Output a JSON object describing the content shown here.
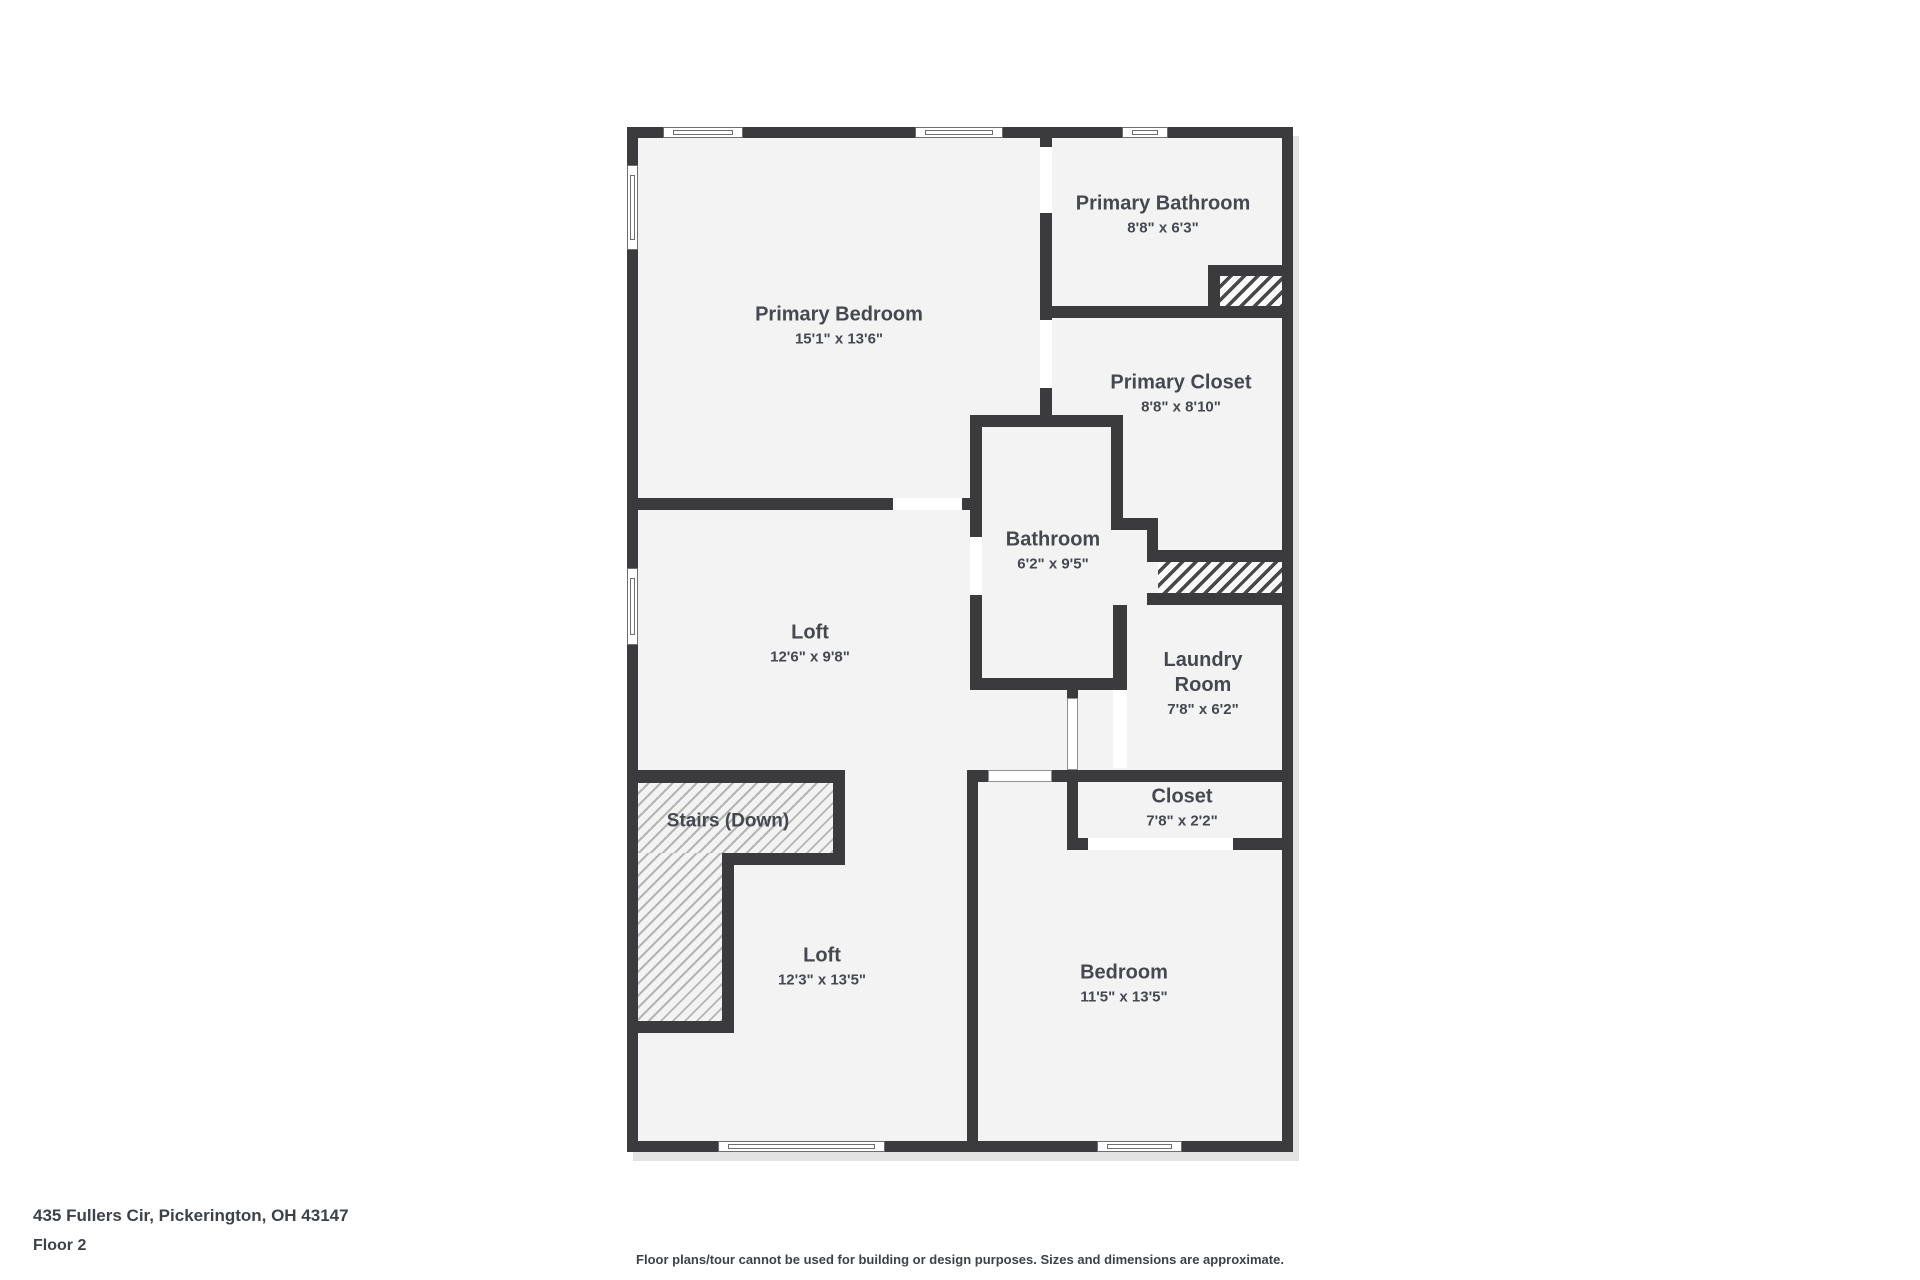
{
  "plan": {
    "bbox": {
      "left": 627,
      "top": 127,
      "width": 666,
      "height": 1025
    },
    "colors": {
      "wall": "#3b3b3d",
      "floor": "#f3f3f3",
      "label_text": "#45484e",
      "footer_text": "#3e4247",
      "shadow": "#e3e3e3"
    },
    "rooms": [
      {
        "id": "primary-bedroom",
        "name": "Primary Bedroom",
        "dims": "15'1\" x 13'6\"",
        "cx": 212,
        "cy": 200
      },
      {
        "id": "primary-bathroom",
        "name": "Primary Bathroom",
        "dims": "8'8\" x 6'3\"",
        "cx": 536,
        "cy": 89
      },
      {
        "id": "primary-closet",
        "name": "Primary Closet",
        "dims": "8'8\" x 8'10\"",
        "cx": 554,
        "cy": 268
      },
      {
        "id": "bathroom",
        "name": "Bathroom",
        "dims": "6'2\" x 9'5\"",
        "cx": 426,
        "cy": 425
      },
      {
        "id": "laundry-room",
        "name": "Laundry Room",
        "dims": "7'8\" x 6'2\"",
        "cx": 576,
        "cy": 558,
        "wrap": true
      },
      {
        "id": "closet",
        "name": "Closet",
        "dims": "7'8\" x 2'2\"",
        "cx": 555,
        "cy": 682
      },
      {
        "id": "bedroom",
        "name": "Bedroom",
        "dims": "11'5\" x 13'5\"",
        "cx": 497,
        "cy": 858
      },
      {
        "id": "loft-upper",
        "name": "Loft",
        "dims": "12'6\" x 9'8\"",
        "cx": 183,
        "cy": 518
      },
      {
        "id": "loft-lower",
        "name": "Loft",
        "dims": "12'3\" x 13'5\"",
        "cx": 195,
        "cy": 841
      },
      {
        "id": "stairs",
        "name": "Stairs (Down)",
        "dims": "",
        "cx": 101,
        "cy": 694
      }
    ],
    "walls": [
      [
        0,
        0,
        666,
        11
      ],
      [
        0,
        1014,
        666,
        11
      ],
      [
        0,
        0,
        11,
        1025
      ],
      [
        655,
        0,
        11,
        1025
      ],
      [
        413,
        11,
        12,
        9
      ],
      [
        413,
        86,
        12,
        107
      ],
      [
        413,
        261,
        12,
        28
      ],
      [
        343,
        288,
        153,
        12
      ],
      [
        413,
        179,
        253,
        12
      ],
      [
        581,
        138,
        12,
        53
      ],
      [
        581,
        138,
        75,
        11
      ],
      [
        484,
        300,
        12,
        103
      ],
      [
        484,
        391,
        47,
        12
      ],
      [
        520,
        403,
        11,
        32
      ],
      [
        520,
        423,
        146,
        12
      ],
      [
        520,
        466,
        146,
        12
      ],
      [
        486,
        478,
        14,
        85
      ],
      [
        343,
        288,
        12,
        122
      ],
      [
        343,
        468,
        12,
        95
      ],
      [
        343,
        551,
        157,
        12
      ],
      [
        0,
        371,
        266,
        12
      ],
      [
        335,
        371,
        20,
        12
      ],
      [
        440,
        563,
        11,
        8
      ],
      [
        440,
        643,
        11,
        80
      ],
      [
        340,
        643,
        21,
        12
      ],
      [
        425,
        643,
        241,
        12
      ],
      [
        340,
        643,
        11,
        382
      ],
      [
        440,
        711,
        21,
        12
      ],
      [
        606,
        711,
        60,
        12
      ],
      [
        0,
        643,
        218,
        13
      ],
      [
        206,
        656,
        12,
        82
      ],
      [
        95,
        726,
        123,
        12
      ],
      [
        95,
        726,
        12,
        180
      ],
      [
        0,
        894,
        107,
        12
      ]
    ],
    "doors": [
      [
        413,
        20,
        12,
        66
      ],
      [
        413,
        193,
        12,
        68
      ],
      [
        266,
        371,
        69,
        12
      ],
      [
        343,
        410,
        12,
        58
      ],
      [
        486,
        563,
        14,
        78
      ],
      [
        461,
        711,
        145,
        12
      ]
    ],
    "cased_openings": [
      [
        440,
        571,
        11,
        72
      ],
      [
        361,
        643,
        64,
        12
      ]
    ],
    "windows": [
      {
        "x": 36,
        "y": 0,
        "w": 80,
        "h": 11,
        "o": "h"
      },
      {
        "x": 288,
        "y": 0,
        "w": 88,
        "h": 11,
        "o": "h"
      },
      {
        "x": 495,
        "y": 0,
        "w": 46,
        "h": 11,
        "o": "h"
      },
      {
        "x": 0,
        "y": 38,
        "w": 11,
        "h": 85,
        "o": "v"
      },
      {
        "x": 0,
        "y": 441,
        "w": 11,
        "h": 77,
        "o": "v"
      },
      {
        "x": 91,
        "y": 1014,
        "w": 167,
        "h": 11,
        "o": "h"
      },
      {
        "x": 470,
        "y": 1014,
        "w": 85,
        "h": 11,
        "o": "h"
      }
    ],
    "hatches": [
      {
        "x": 593,
        "y": 149,
        "w": 62,
        "h": 30,
        "variant": "dark"
      },
      {
        "x": 531,
        "y": 435,
        "w": 124,
        "h": 31,
        "variant": "dark"
      },
      {
        "x": 11,
        "y": 656,
        "w": 195,
        "h": 70,
        "variant": "light"
      },
      {
        "x": 11,
        "y": 726,
        "w": 84,
        "h": 168,
        "variant": "light"
      }
    ]
  },
  "footer": {
    "address": "435 Fullers Cir, Pickerington, OH 43147",
    "floor": "Floor 2",
    "disclaimer": "Floor plans/tour cannot be used for building or design purposes. Sizes and dimensions are approximate."
  }
}
